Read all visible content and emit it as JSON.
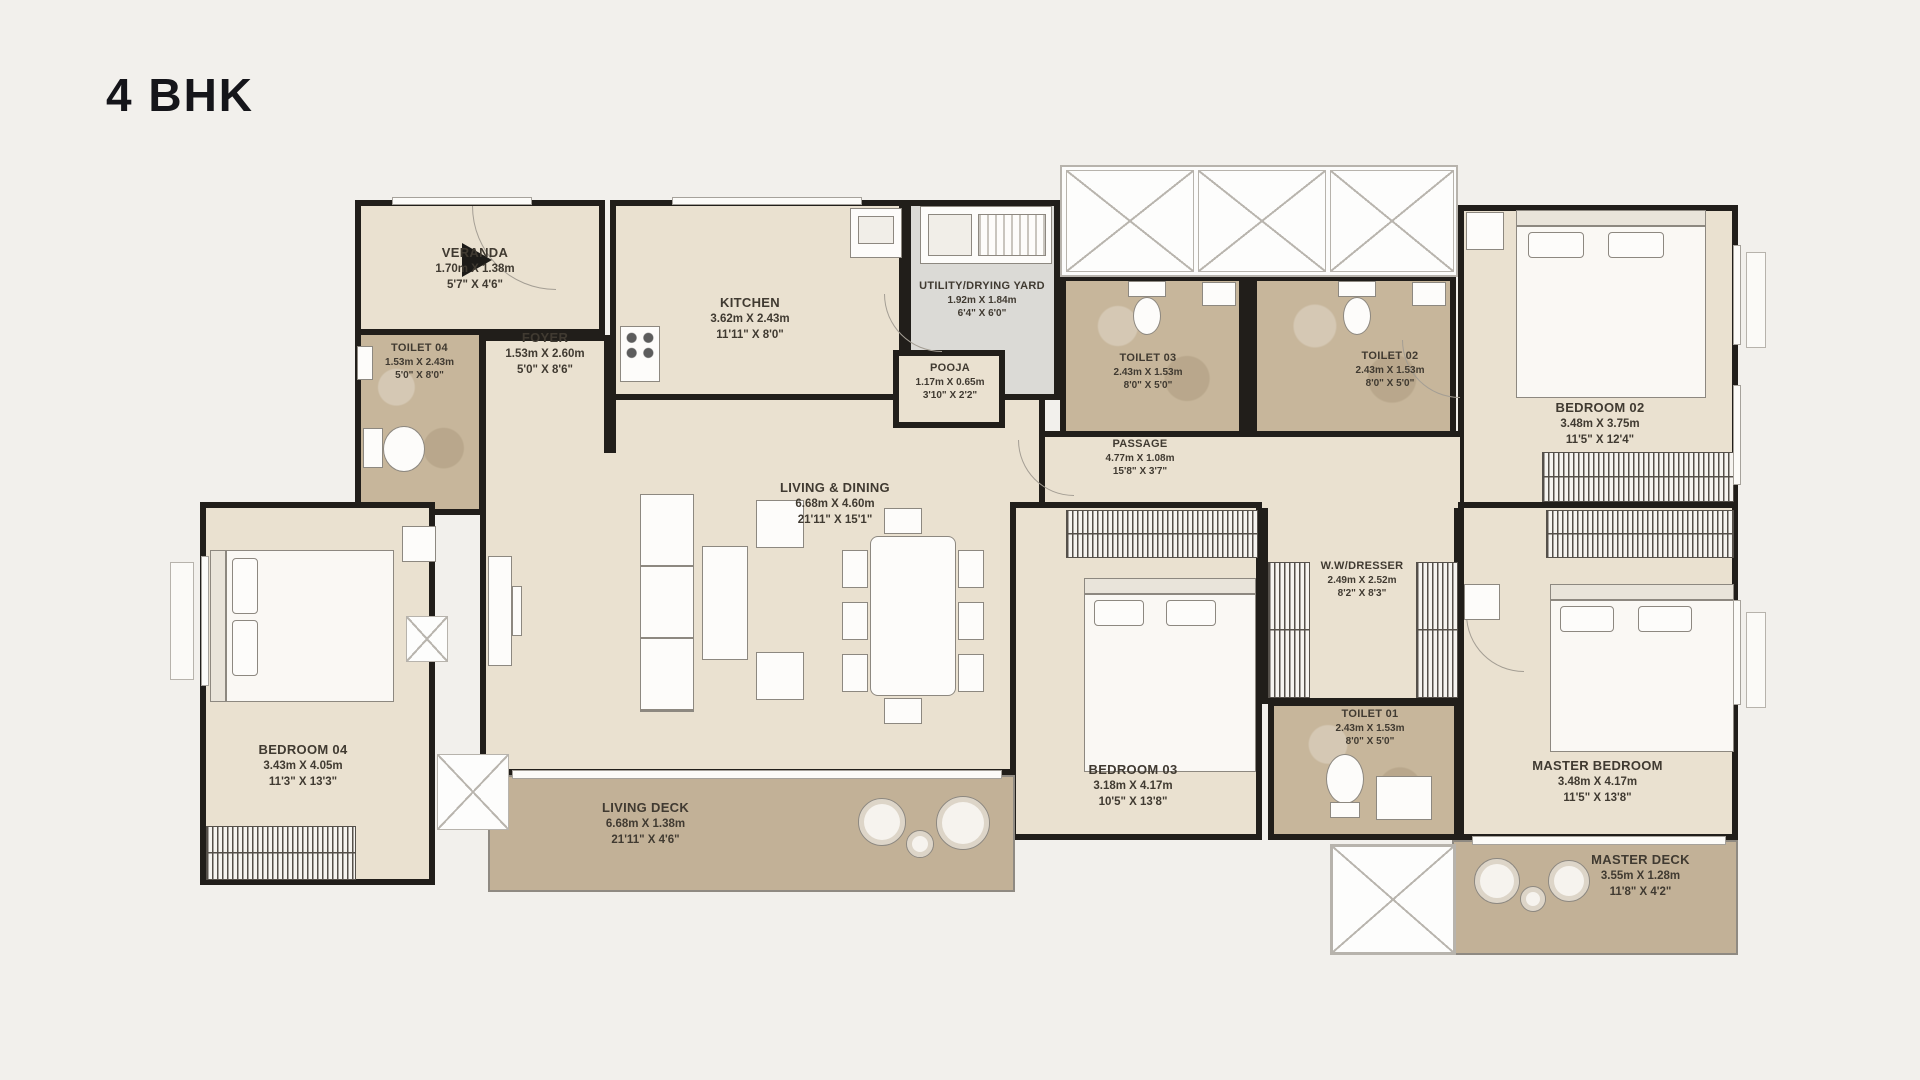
{
  "title": "4 BHK",
  "colors": {
    "wall": "#211e1a",
    "floor_beige": "#eae1d0",
    "floor_toilet": "#c7b69b",
    "floor_utility": "#dbdad6",
    "floor_deck": "#c2b197",
    "background": "#f2f0ec",
    "label_text": "#403a31"
  },
  "rooms": [
    {
      "id": "veranda",
      "name": "VERANDA",
      "dim_m": "1.70m X 1.38m",
      "dim_ft": "5'7\" X 4'6\""
    },
    {
      "id": "toilet-04",
      "name": "TOILET 04",
      "dim_m": "1.53m X 2.43m",
      "dim_ft": "5'0\" X 8'0\""
    },
    {
      "id": "foyer",
      "name": "FOYER",
      "dim_m": "1.53m X 2.60m",
      "dim_ft": "5'0\" X 8'6\""
    },
    {
      "id": "kitchen",
      "name": "KITCHEN",
      "dim_m": "3.62m X 2.43m",
      "dim_ft": "11'11\" X 8'0\""
    },
    {
      "id": "utility-drying-yard",
      "name": "UTILITY/DRYING YARD",
      "dim_m": "1.92m X 1.84m",
      "dim_ft": "6'4\" X 6'0\""
    },
    {
      "id": "pooja",
      "name": "POOJA",
      "dim_m": "1.17m X 0.65m",
      "dim_ft": "3'10\" X 2'2\""
    },
    {
      "id": "toilet-03",
      "name": "TOILET 03",
      "dim_m": "2.43m X 1.53m",
      "dim_ft": "8'0\" X 5'0\""
    },
    {
      "id": "toilet-02",
      "name": "TOILET 02",
      "dim_m": "2.43m X 1.53m",
      "dim_ft": "8'0\" X 5'0\""
    },
    {
      "id": "bedroom-02",
      "name": "BEDROOM 02",
      "dim_m": "3.48m X 3.75m",
      "dim_ft": "11'5\" X 12'4\""
    },
    {
      "id": "passage",
      "name": "PASSAGE",
      "dim_m": "4.77m X 1.08m",
      "dim_ft": "15'8\" X 3'7\""
    },
    {
      "id": "living-dining",
      "name": "LIVING & DINING",
      "dim_m": "6.68m X 4.60m",
      "dim_ft": "21'11\" X 15'1\""
    },
    {
      "id": "ww-dresser",
      "name": "W.W/DRESSER",
      "dim_m": "2.49m X 2.52m",
      "dim_ft": "8'2\" X 8'3\""
    },
    {
      "id": "bedroom-03",
      "name": "BEDROOM 03",
      "dim_m": "3.18m X 4.17m",
      "dim_ft": "10'5\" X 13'8\""
    },
    {
      "id": "toilet-01",
      "name": "TOILET 01",
      "dim_m": "2.43m X 1.53m",
      "dim_ft": "8'0\" X 5'0\""
    },
    {
      "id": "master-bedroom",
      "name": "MASTER BEDROOM",
      "dim_m": "3.48m X 4.17m",
      "dim_ft": "11'5\" X 13'8\""
    },
    {
      "id": "bedroom-04",
      "name": "BEDROOM 04",
      "dim_m": "3.43m X 4.05m",
      "dim_ft": "11'3\" X 13'3\""
    },
    {
      "id": "living-deck",
      "name": "LIVING DECK",
      "dim_m": "6.68m X 1.38m",
      "dim_ft": "21'11\" X 4'6\""
    },
    {
      "id": "master-deck",
      "name": "MASTER DECK",
      "dim_m": "3.55m X 1.28m",
      "dim_ft": "11'8\" X 4'2\""
    }
  ]
}
